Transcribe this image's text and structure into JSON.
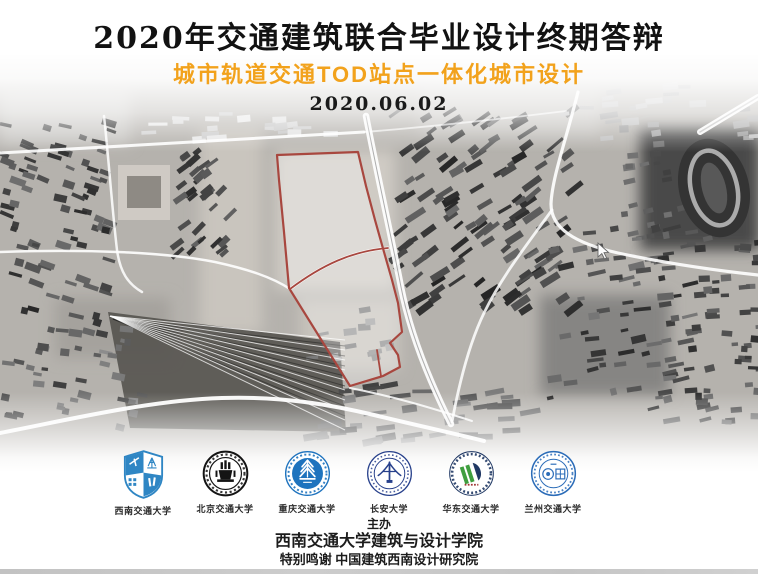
{
  "slide": {
    "title": "2020年交通建筑联合毕业设计终期答辩",
    "subtitle": "城市轨道交通TOD站点一体化城市设计",
    "date": "2020.06.02"
  },
  "colors": {
    "subtitle_orange": "#F2A21C",
    "site_boundary_red": "#A8473F"
  },
  "universities": [
    {
      "name": "西南交通大学",
      "logo_icon": "swjtu-shield-logo"
    },
    {
      "name": "北京交通大学",
      "logo_icon": "bjtu-seal-logo"
    },
    {
      "name": "重庆交通大学",
      "logo_icon": "cqjtu-seal-logo"
    },
    {
      "name": "长安大学",
      "logo_icon": "changan-seal-logo"
    },
    {
      "name": "华东交通大学",
      "logo_icon": "ecjtu-seal-logo"
    },
    {
      "name": "兰州交通大学",
      "logo_icon": "lzjtu-seal-logo"
    }
  ],
  "footer": {
    "organizer_label": "主办",
    "organizer_name": "西南交通大学建筑与设计学院",
    "special_thanks": "特别鸣谢 中国建筑西南设计研究院"
  }
}
